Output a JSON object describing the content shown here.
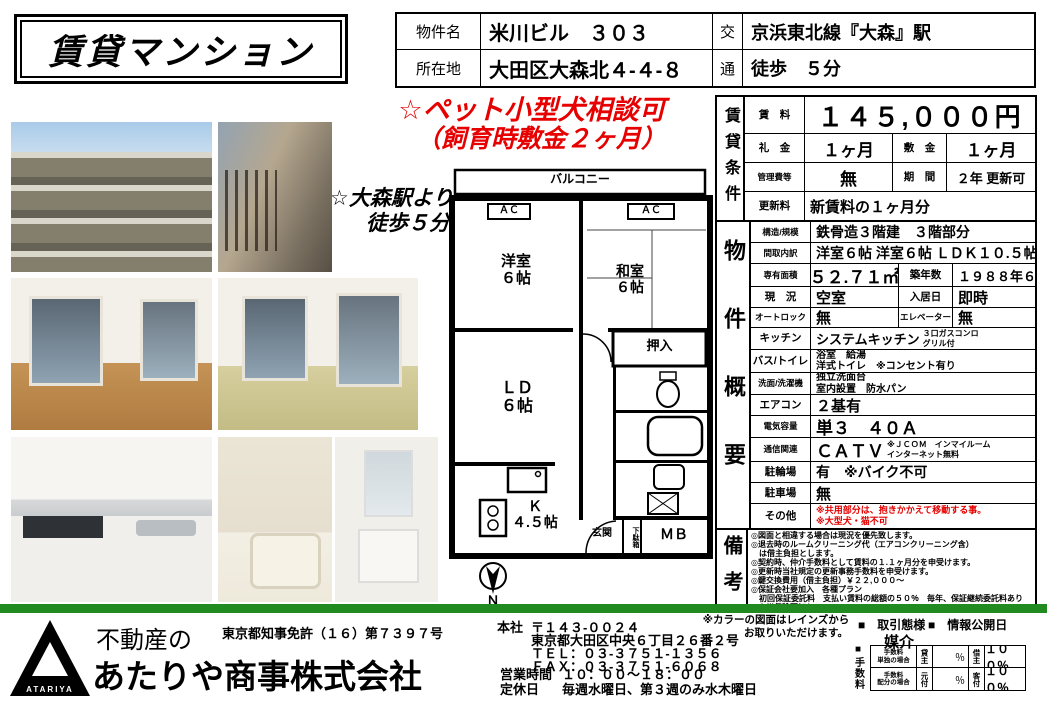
{
  "colors": {
    "bar_green": "#218a21",
    "alert_red": "#e60000"
  },
  "header": {
    "title": "賃貸マンション",
    "property_label": "物件名",
    "property_name": "米川ビル　３０３",
    "address_label": "所在地",
    "address_value": "大田区大森北４-４-８",
    "transport_char1": "交",
    "transport_char2": "通",
    "transport_line": "京浜東北線『大森』駅",
    "transport_walk": "徒歩　５分"
  },
  "promo": {
    "pet_line1": "☆ペット小型犬相談可",
    "pet_line2": "（飼育時敷金２ヶ月）",
    "station_line1": "☆大森駅より",
    "station_line2": "徒歩５分"
  },
  "floorplan": {
    "balcony": "バルコニー",
    "ac_left": "ＡＣ",
    "ac_right": "ＡＣ",
    "western_room": "洋室\n６帖",
    "japanese_room": "和室\n６帖",
    "closet": "押入",
    "living": "ＬＤ\n６帖",
    "kitchen": "Ｋ\n４.５帖",
    "entrance": "玄関",
    "shoe_box": "下駄箱",
    "meter_box": "ＭＢ",
    "north": "Ｎ"
  },
  "conditions": {
    "section_label": "賃貸条件",
    "rent_label": "賃　料",
    "rent_value": "１４５,０００円",
    "key_money_label": "礼　金",
    "key_money_value": "１ヶ月",
    "deposit_label": "敷　金",
    "deposit_value": "１ヶ月",
    "mgmt_fee_label": "管理費等",
    "mgmt_fee_value": "無",
    "term_label": "期　間",
    "term_value": "２年 更新可",
    "renewal_label": "更新料",
    "renewal_value": "新賃料の１ヶ月分"
  },
  "overview": {
    "section_label": "物件概要",
    "rows": [
      {
        "label": "構造/規模",
        "value": "鉄骨造３階建　３階部分"
      },
      {
        "label": "間取内訳",
        "value": "洋室６帖 洋室６帖 ＬＤＫ１０.５帖"
      },
      {
        "label": "専有面積",
        "value": "５２.７１㎡",
        "label2": "築年数",
        "value2": "１９８８年６月"
      },
      {
        "label": "現　況",
        "value": "空室",
        "label2": "入居日",
        "value2": "即時"
      },
      {
        "label": "オートロック",
        "value": "無",
        "label2": "エレベーター",
        "value2": "無"
      },
      {
        "label": "キッチン",
        "value": "システムキッチン",
        "note": "３口ガスコンロ\nグリル付"
      },
      {
        "label": "バス/トイレ",
        "value": "浴室　給湯\n洋式トイレ　※コンセント有り"
      },
      {
        "label": "洗面/洗濯機",
        "value": "独立洗面台\n室内設置　防水パン"
      },
      {
        "label": "エアコン",
        "value": "２基有"
      },
      {
        "label": "電気容量",
        "value": "単３　４０Ａ"
      },
      {
        "label": "通信関連",
        "value": "ＣＡＴＶ",
        "note": "※ＪＣＯＭ　インマイルーム\nインターネット無料"
      },
      {
        "label": "駐輪場",
        "value": "有　※バイク不可"
      },
      {
        "label": "駐車場",
        "value": "無"
      },
      {
        "label": "その他",
        "value": "※共用部分は、抱きかかえて移動する事。\n※大型犬・猫不可"
      }
    ]
  },
  "remarks": {
    "section_label": "備考",
    "lines": [
      "◎図面と相違する場合は現況を優先致します。",
      "◎退去時のルームクリーニング代（エアコンクリーニング含）",
      "　は借主負担とします。",
      "◎契約時、仲介手数料として賃料の１.１ヶ月分を申受けます。",
      "◎更新時当社規定の更新事務手数料を申受けます。",
      "◎鍵交換費用（借主負担）￥２２,０００～",
      "◎保証会社要加入　各種プラン",
      "　初回保証委託料　支払い賃料の総額の５０％　毎年、保証継続委託料あり",
      "◎火災保険要加入"
    ]
  },
  "footer": {
    "company_prefix": "不動産の",
    "company_name": "あたりや商事株式会社",
    "logo_text": "ATARIYA",
    "license": "東京都知事免許（１６）第７３９７号",
    "office_label": "本社",
    "postal_code": "〒１４３-００２４",
    "office_address": "東京都大田区中央６丁目２６番２号",
    "tel": "ＴＥＬ：０３-３７５１-１３５６",
    "fax": "ＦＡＸ：０３-３７５１-６０６８",
    "hours_label": "営業時間",
    "hours_value": "１０：００～１８：００",
    "holiday_label": "定休日",
    "holiday_value": "毎週水曜日、第３週のみ水木曜日",
    "reins_note_line1": "※カラーの図面はレインズから",
    "reins_note_line2": "お取りいただけます。",
    "deal_type_label": "■　取引態様",
    "deal_type_value": "媒介",
    "info_date_label": "■　情報公開日",
    "fee_bullet": "■",
    "fee_section_label": "手数料",
    "fee_rows": [
      {
        "name_line1": "手数料",
        "name_line2": "単独の場合",
        "party1": "貸主",
        "value1": "％",
        "party2": "借主",
        "value2": "１００％"
      },
      {
        "name_line1": "手数料",
        "name_line2": "配分の場合",
        "party1": "元付",
        "value1": "％",
        "party2": "客付",
        "value2": "１００％"
      }
    ]
  }
}
